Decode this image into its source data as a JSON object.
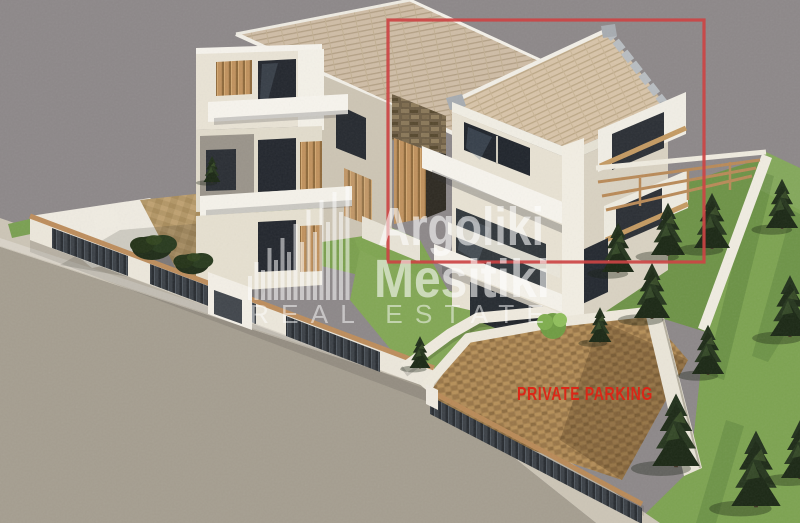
{
  "scene": {
    "description": "3D exterior render of a modern two-unit residential complex with gardens, lawn and private parking, viewed from above",
    "background_color": "#8d8889"
  },
  "watermark": {
    "logo": "skyline-bars-icon",
    "brand_line1": "Argoliki",
    "brand_line2": "Mesitiki",
    "brand_line3": "REAL ESTATE",
    "text_color": "#ffffff"
  },
  "annotations": {
    "private_parking_label": "PRIVATE PARKING",
    "private_parking_color": "#de2315",
    "highlight_color": "#cc4444",
    "highlight_box": {
      "x": 388,
      "y": 20,
      "width": 316,
      "height": 242
    }
  },
  "palette": {
    "roof_tiles": "#d8c4a9",
    "wall_light": "#efeadf",
    "wall_shadow": "#d7d0c0",
    "wood_accent": "#c0925e",
    "grass": "#7da351",
    "grass_dark": "#5f8440",
    "road": "#a59e90",
    "sidewalk": "#ccc5b6",
    "parking_paving": "#a5814f",
    "dark_fence": "#3c4147",
    "tree_green": "#22311c"
  }
}
